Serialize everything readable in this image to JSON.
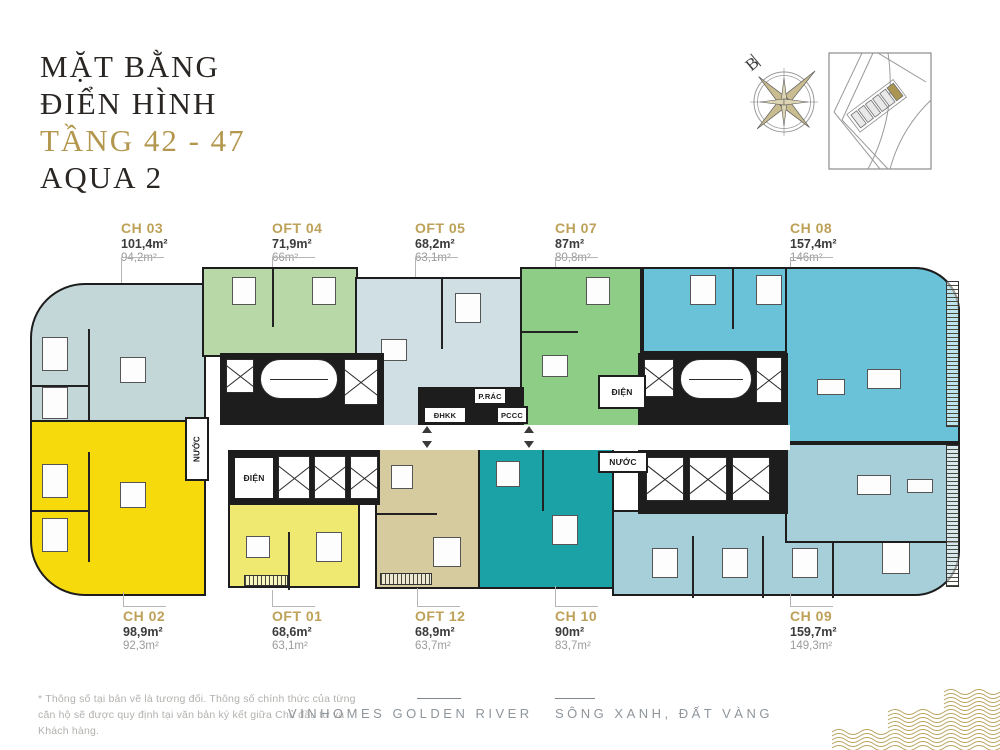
{
  "title": {
    "line1": "MẶT BẰNG",
    "line2": "ĐIỂN HÌNH",
    "floors": "TẦNG 42 - 47",
    "building": "AQUA 2"
  },
  "compass": {
    "north_label": "B"
  },
  "units": {
    "top": [
      {
        "code": "CH 03",
        "gross": "101,4m²",
        "net": "94,2m²",
        "color": "#c3d7d9"
      },
      {
        "code": "OFT 04",
        "gross": "71,9m²",
        "net": "66m²",
        "color": "#b8d9a7"
      },
      {
        "code": "OFT 05",
        "gross": "68,2m²",
        "net": "63,1m²",
        "color": "#cfdfe3"
      },
      {
        "code": "CH 07",
        "gross": "87m²",
        "net": "80,8m²",
        "color": "#8ecd86"
      },
      {
        "code": "CH 08",
        "gross": "157,4m²",
        "net": "146m²",
        "color": "#6ac2d9"
      }
    ],
    "bottom": [
      {
        "code": "CH 02",
        "gross": "98,9m²",
        "net": "92,3m²",
        "color": "#f6da0c"
      },
      {
        "code": "OFT 01",
        "gross": "68,6m²",
        "net": "63,1m²",
        "color": "#efe871"
      },
      {
        "code": "OFT 12",
        "gross": "68,9m²",
        "net": "63,7m²",
        "color": "#d5cb9e"
      },
      {
        "code": "CH 10",
        "gross": "90m²",
        "net": "83,7m²",
        "color": "#1ba2a6"
      },
      {
        "code": "CH 09",
        "gross": "159,7m²",
        "net": "149,3m²",
        "color": "#a6cfda"
      }
    ]
  },
  "plan_rooms": {
    "electrical": "ĐIỆN",
    "water": "NƯỚC",
    "air_handling": "ĐHKK",
    "trash": "P.RÁC",
    "fire": "PCCC"
  },
  "footer": {
    "disclaimer": "* Thông số tại bản vẽ là tương đối. Thông số chính thức của từng căn hộ sẽ được quy định tại văn bản ký kết giữa Chủ đầu tư và Khách hàng.",
    "brand": "VINHOMES GOLDEN RIVER",
    "slogan": "SÔNG XANH, ĐẤT VÀNG"
  },
  "colors": {
    "accent_gold": "#b3974e",
    "label_gold": "#bda158",
    "title_dark": "#2a2624",
    "wall_black": "#1d1d1d",
    "muted_text": "#9b9b9b",
    "wave_gold": "#b9a561"
  }
}
